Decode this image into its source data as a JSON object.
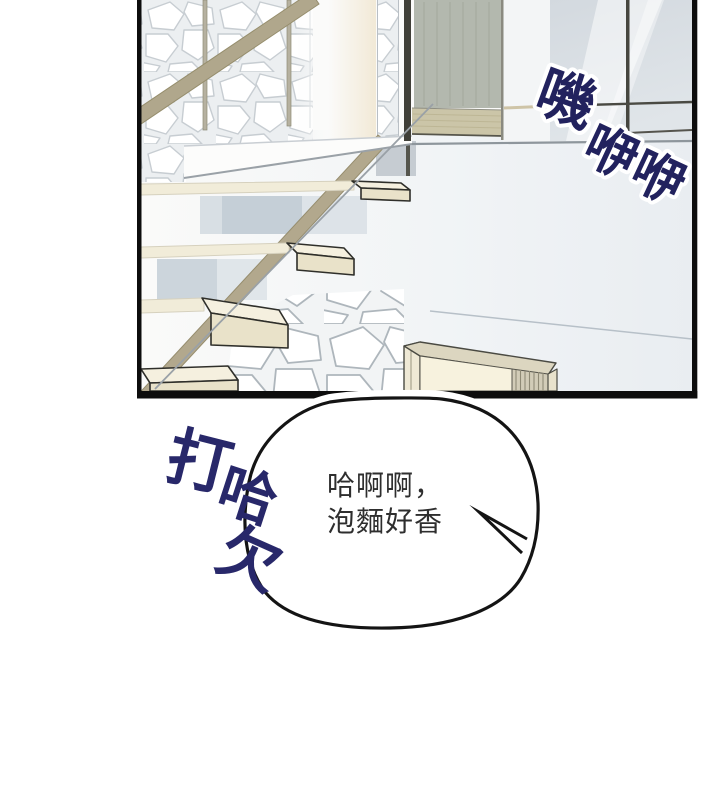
{
  "sfx_glass_rattle": {
    "full_text": "嘰咿咿",
    "chars": [
      "嘰",
      "咿",
      "咿"
    ],
    "color": "#22225e",
    "outline_color": "#ffffff"
  },
  "speech_bubble": {
    "full_text": "哈啊啊，泡麵好香",
    "lines": [
      "哈啊啊，",
      "泡麵好香"
    ],
    "text_color": "#2e2e2e",
    "outline_color": "#141414",
    "fill_color": "#ffffff"
  },
  "sfx_yawn": {
    "full_text": "打哈欠",
    "chars": [
      "打",
      "哈",
      "欠"
    ],
    "color": "#28286a"
  },
  "panel": {
    "border_color": "#0d0d0d",
    "background_color": "#fbfbfa",
    "step_color": "#f1ecd9",
    "stringer_color": "#b2a88d",
    "door_color": "#b3b8ae",
    "glass_color": "#d8dee3"
  }
}
